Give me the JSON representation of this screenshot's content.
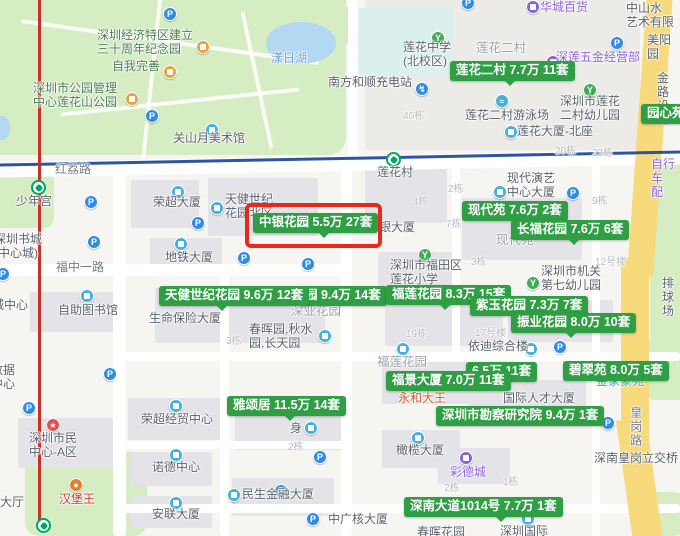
{
  "colors": {
    "price_label_bg": "#2f9e44",
    "highlight_box_red": "#e6291c",
    "park_green": "#d6ecc2",
    "road_yellow": "#f6da7c",
    "metro_red_line": "#c73228",
    "metro_blue_line": "#2c55a5",
    "parking_icon_blue": "#2e8be6",
    "building_icon_blue": "#45b0dd",
    "education_icon_green": "#41ab5a",
    "metro_station_green": "#00a865"
  },
  "highlight_box": {
    "x": 245,
    "y": 203,
    "w": 137,
    "h": 45
  },
  "price_labels": [
    {
      "text": "莲花二村 7.7万 11套",
      "x": 450,
      "y": 61,
      "ptr": 55,
      "z": 8,
      "highlighted": false
    },
    {
      "text": "园心苑",
      "x": 641,
      "y": 104,
      "ptr": -1,
      "z": 8,
      "highlighted": false
    },
    {
      "text": "现代苑 7.6万 2套",
      "x": 462,
      "y": 201,
      "ptr": -1,
      "z": 8,
      "highlighted": false
    },
    {
      "text": "长福花园 7.6万 6套",
      "x": 511,
      "y": 220,
      "ptr": 58,
      "z": 8,
      "highlighted": false
    },
    {
      "text": "园 9.4万 14套",
      "x": 299,
      "y": 286,
      "ptr": -1,
      "z": 7,
      "highlighted": false
    },
    {
      "text": "天健世纪花园 9.6万 12套",
      "x": 159,
      "y": 286,
      "ptr": 58,
      "z": 8,
      "highlighted": false
    },
    {
      "text": "福莲花园 8.3万 15套",
      "x": 386,
      "y": 285,
      "ptr": 54,
      "z": 7,
      "highlighted": false
    },
    {
      "text": "紫玉花园 7.3万 7套",
      "x": 470,
      "y": 296,
      "ptr": -1,
      "z": 8,
      "highlighted": false
    },
    {
      "text": "振业花园 8.0万 10套",
      "x": 511,
      "y": 313,
      "ptr": 55,
      "z": 8,
      "highlighted": false
    },
    {
      "text": "6.5万 11套",
      "x": 466,
      "y": 362,
      "ptr": -1,
      "z": 7,
      "highlighted": false
    },
    {
      "text": "碧翠苑 8.0万 5套",
      "x": 563,
      "y": 361,
      "ptr": -1,
      "z": 8,
      "highlighted": false
    },
    {
      "text": "福景大厦 7.0万 11套",
      "x": 386,
      "y": 371,
      "ptr": -1,
      "z": 9,
      "highlighted": false
    },
    {
      "text": "雅颂居 11.5万 14套",
      "x": 227,
      "y": 396,
      "ptr": 58,
      "z": 8,
      "highlighted": false
    },
    {
      "text": "深圳市勘察研究院 9.4万 1套",
      "x": 436,
      "y": 406,
      "ptr": -1,
      "z": 8,
      "highlighted": false
    },
    {
      "text": "深南大道1014号 7.7万 1套",
      "x": 404,
      "y": 497,
      "ptr": 92,
      "z": 8,
      "highlighted": false
    },
    {
      "text": "中银花园 5.5万 27套",
      "x": 253,
      "y": 213,
      "ptr": 66,
      "z": 9,
      "highlighted": true
    }
  ],
  "poi_labels": [
    {
      "text": "深圳经济特区建立\n三十周年纪念园",
      "x": 97,
      "y": 29,
      "style": "park"
    },
    {
      "text": "自我完善",
      "x": 112,
      "y": 60,
      "style": "park"
    },
    {
      "text": "深圳市公园管理\n中心莲花山公园",
      "x": 33,
      "y": 82,
      "style": "park"
    },
    {
      "text": "漾日湖",
      "x": 271,
      "y": 52,
      "style": "water-t"
    },
    {
      "text": "关山月美术馆",
      "x": 173,
      "y": 132,
      "style": ""
    },
    {
      "text": "南方和顺充电站",
      "x": 328,
      "y": 76,
      "style": ""
    },
    {
      "text": "华城百货",
      "x": 540,
      "y": 1,
      "style": "purple"
    },
    {
      "text": "中山水\n艺术有限",
      "x": 626,
      "y": 2,
      "style": ""
    },
    {
      "text": "莲花中学\n(北校区)",
      "x": 403,
      "y": 41,
      "style": ""
    },
    {
      "text": "莲花二村",
      "x": 476,
      "y": 41,
      "style": "area"
    },
    {
      "text": "深莲五金经营部",
      "x": 556,
      "y": 51,
      "style": "purple"
    },
    {
      "text": "美阳园",
      "x": 647,
      "y": 34,
      "style": ""
    },
    {
      "text": "莲花二村游泳场",
      "x": 465,
      "y": 109,
      "style": ""
    },
    {
      "text": "深圳市莲花\n二村幼儿园",
      "x": 560,
      "y": 95,
      "style": ""
    },
    {
      "text": "莲花大厦-北座",
      "x": 517,
      "y": 125,
      "style": ""
    },
    {
      "text": "金路\n设施",
      "x": 657,
      "y": 72,
      "style": ""
    },
    {
      "text": "自行车\n配",
      "x": 651,
      "y": 158,
      "style": "purple"
    },
    {
      "text": "莲花村",
      "x": 377,
      "y": 166,
      "style": ""
    },
    {
      "text": "少年宫",
      "x": 16,
      "y": 195,
      "style": ""
    },
    {
      "text": "深圳书城\n(中心城)",
      "x": -6,
      "y": 233,
      "style": ""
    },
    {
      "text": "荣超大厦",
      "x": 153,
      "y": 196,
      "style": ""
    },
    {
      "text": "天健世纪\n花园北区",
      "x": 225,
      "y": 193,
      "style": ""
    },
    {
      "text": "中银大厦",
      "x": 367,
      "y": 221,
      "style": ""
    },
    {
      "text": "现代演艺\n中心大厦",
      "x": 507,
      "y": 172,
      "style": ""
    },
    {
      "text": "现代苑",
      "x": 496,
      "y": 233,
      "style": "area"
    },
    {
      "text": "地铁大厦",
      "x": 165,
      "y": 251,
      "style": ""
    },
    {
      "text": "深圳市福田区\n莲花小学",
      "x": 390,
      "y": 259,
      "style": ""
    },
    {
      "text": "深圳市机关\n第七幼儿园",
      "x": 541,
      "y": 265,
      "style": ""
    },
    {
      "text": "自助图书馆",
      "x": 58,
      "y": 304,
      "style": ""
    },
    {
      "text": "城中心",
      "x": -8,
      "y": 299,
      "style": ""
    },
    {
      "text": "生命保险大厦",
      "x": 149,
      "y": 312,
      "style": ""
    },
    {
      "text": "深业花园",
      "x": 291,
      "y": 304,
      "style": "area"
    },
    {
      "text": "春晖园,秋水\n园,长天园",
      "x": 249,
      "y": 323,
      "style": ""
    },
    {
      "text": "依迪综合楼",
      "x": 468,
      "y": 340,
      "style": ""
    },
    {
      "text": "福莲花园",
      "x": 377,
      "y": 355,
      "style": "area"
    },
    {
      "text": "排球场",
      "x": 662,
      "y": 277,
      "style": ""
    },
    {
      "text": "永和大王",
      "x": 398,
      "y": 392,
      "style": "orange"
    },
    {
      "text": "国际人才大厦",
      "x": 503,
      "y": 392,
      "style": ""
    },
    {
      "text": "金家豪苑",
      "x": 596,
      "y": 375,
      "style": "teal"
    },
    {
      "text": "深圳市民\n中心-A区",
      "x": 29,
      "y": 432,
      "style": ""
    },
    {
      "text": "汉堡王",
      "x": 59,
      "y": 493,
      "style": "red"
    },
    {
      "text": "大厅",
      "x": 0,
      "y": 496,
      "style": ""
    },
    {
      "text": "数据\n中心",
      "x": -9,
      "y": 364,
      "style": ""
    },
    {
      "text": "荣超经贸中心",
      "x": 141,
      "y": 413,
      "style": ""
    },
    {
      "text": "身",
      "x": 290,
      "y": 422,
      "style": ""
    },
    {
      "text": "诺德中心",
      "x": 152,
      "y": 461,
      "style": ""
    },
    {
      "text": "安联大厦",
      "x": 152,
      "y": 508,
      "style": ""
    },
    {
      "text": "民生金融大厦",
      "x": 242,
      "y": 488,
      "style": ""
    },
    {
      "text": "中广核大厦",
      "x": 328,
      "y": 513,
      "style": ""
    },
    {
      "text": "橄榄大厦",
      "x": 396,
      "y": 444,
      "style": ""
    },
    {
      "text": "彩德城",
      "x": 450,
      "y": 466,
      "style": "purple"
    },
    {
      "text": "深南皇岗立交桥",
      "x": 594,
      "y": 452,
      "style": ""
    },
    {
      "text": "春晖花园",
      "x": 417,
      "y": 526,
      "style": ""
    },
    {
      "text": "深圳国际",
      "x": 500,
      "y": 525,
      "style": ""
    }
  ],
  "road_labels": [
    {
      "text": "红荔路",
      "x": 55,
      "y": 163,
      "vertical": false
    },
    {
      "text": "福中一路",
      "x": 56,
      "y": 261,
      "vertical": false
    },
    {
      "text": "皇岗路",
      "x": 628,
      "y": 406,
      "vertical": true
    }
  ],
  "building_numbers": [
    {
      "text": "40栋",
      "x": 403,
      "y": 111
    },
    {
      "text": "20栋",
      "x": 555,
      "y": 146
    },
    {
      "text": "23栋",
      "x": 592,
      "y": 148
    },
    {
      "text": "2栋",
      "x": 448,
      "y": 184
    },
    {
      "text": "4栋",
      "x": 413,
      "y": 197
    },
    {
      "text": "9栋",
      "x": 592,
      "y": 196
    },
    {
      "text": "7栋",
      "x": 446,
      "y": 219
    },
    {
      "text": "3栋",
      "x": 471,
      "y": 257
    },
    {
      "text": "12号楼",
      "x": 595,
      "y": 257
    },
    {
      "text": "19栋",
      "x": 406,
      "y": 329
    },
    {
      "text": "17号楼",
      "x": 475,
      "y": 328
    },
    {
      "text": "3栋",
      "x": 226,
      "y": 336
    },
    {
      "text": "2栋",
      "x": 288,
      "y": 442
    },
    {
      "text": "1栋",
      "x": 503,
      "y": 477
    },
    {
      "text": "2栋",
      "x": 444,
      "y": 483
    }
  ],
  "icons": [
    {
      "type": "P",
      "x": 163,
      "y": 7
    },
    {
      "type": "P",
      "x": 461,
      "y": -4
    },
    {
      "type": "P",
      "x": 610,
      "y": 36
    },
    {
      "type": "P",
      "x": 145,
      "y": 109
    },
    {
      "type": "P",
      "x": 84,
      "y": 195
    },
    {
      "type": "P",
      "x": 87,
      "y": 235
    },
    {
      "type": "P",
      "x": -4,
      "y": 267
    },
    {
      "type": "P",
      "x": 191,
      "y": 216
    },
    {
      "type": "P",
      "x": 237,
      "y": 251
    },
    {
      "type": "P",
      "x": 301,
      "y": 257
    },
    {
      "type": "P",
      "x": 566,
      "y": 186
    },
    {
      "type": "P",
      "x": 103,
      "y": 367
    },
    {
      "type": "P",
      "x": 22,
      "y": 401
    },
    {
      "type": "P",
      "x": 553,
      "y": 340
    },
    {
      "type": "P",
      "x": 601,
      "y": 416
    },
    {
      "type": "P",
      "x": 274,
      "y": 484
    },
    {
      "type": "P",
      "x": 313,
      "y": 450
    },
    {
      "type": "P",
      "x": 306,
      "y": 512
    },
    {
      "type": "orangeic",
      "x": 196,
      "y": 40
    },
    {
      "type": "orangeic",
      "x": 163,
      "y": 65
    },
    {
      "type": "orangeic",
      "x": 125,
      "y": 92
    },
    {
      "type": "bldg",
      "x": 205,
      "y": 123
    },
    {
      "type": "charge",
      "x": 415,
      "y": 82
    },
    {
      "type": "edu",
      "x": 431,
      "y": 31
    },
    {
      "type": "purpleic",
      "x": 526,
      "y": 0
    },
    {
      "type": "purpleic",
      "x": 546,
      "y": 55
    },
    {
      "type": "swim",
      "x": 495,
      "y": 94
    },
    {
      "type": "edu",
      "x": 583,
      "y": 83
    },
    {
      "type": "bldg",
      "x": 504,
      "y": 125
    },
    {
      "type": "bldg",
      "x": 171,
      "y": 185
    },
    {
      "type": "bldg",
      "x": 210,
      "y": 201
    },
    {
      "type": "bldg",
      "x": 493,
      "y": 185
    },
    {
      "type": "bldg",
      "x": 174,
      "y": 237
    },
    {
      "type": "edu",
      "x": 418,
      "y": 248
    },
    {
      "type": "edu",
      "x": 526,
      "y": 276
    },
    {
      "type": "bldg",
      "x": 80,
      "y": 289
    },
    {
      "type": "bldg",
      "x": 318,
      "y": 329
    },
    {
      "type": "bldg",
      "x": 524,
      "y": 342
    },
    {
      "type": "bldg",
      "x": 396,
      "y": 342
    },
    {
      "type": "staric",
      "x": 46,
      "y": 418
    },
    {
      "type": "bldg",
      "x": 169,
      "y": 399
    },
    {
      "type": "bldg",
      "x": 304,
      "y": 421
    },
    {
      "type": "bldg",
      "x": 169,
      "y": 448
    },
    {
      "type": "burger",
      "x": 69,
      "y": 478
    },
    {
      "type": "bldg",
      "x": 169,
      "y": 496
    },
    {
      "type": "bldg",
      "x": 227,
      "y": 488
    },
    {
      "type": "bldg",
      "x": 411,
      "y": 431
    },
    {
      "type": "purpleic",
      "x": 459,
      "y": 451
    },
    {
      "type": "bldg",
      "x": 521,
      "y": 512
    }
  ],
  "transit": {
    "stations": [
      {
        "name": "少年宫",
        "x": 31,
        "y": 180
      },
      {
        "name": "莲花村",
        "x": 386,
        "y": 152
      },
      {
        "name": "",
        "x": 36,
        "y": 518
      }
    ]
  }
}
